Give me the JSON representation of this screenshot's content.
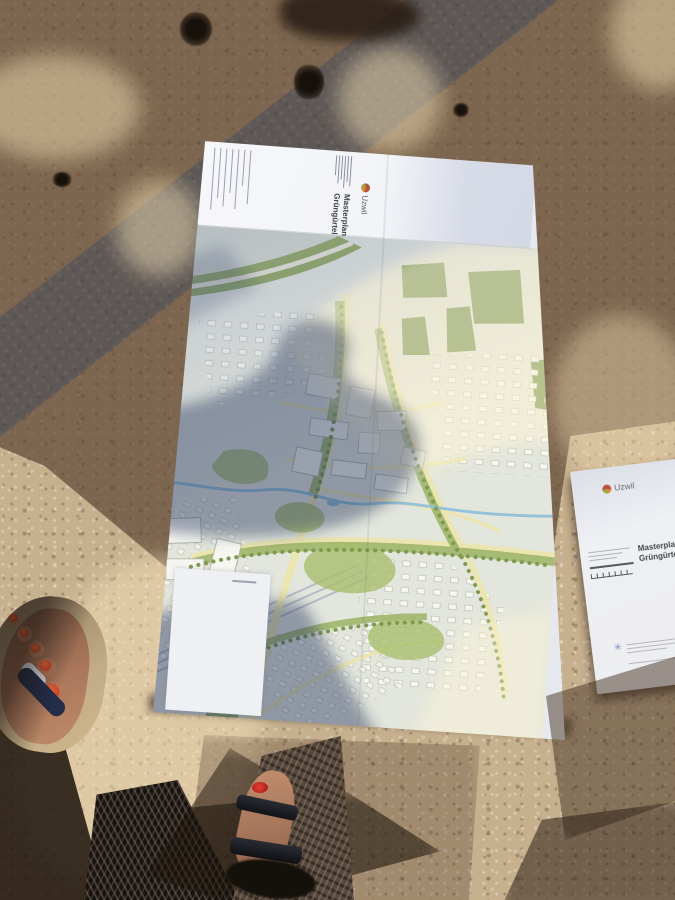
{
  "map_sheet": {
    "title_block": {
      "title_line1": "Masterplan",
      "title_line2": "Grüngürtel",
      "brand": "Uzwil"
    }
  },
  "right_paper": {
    "brand": "Uzwil",
    "title_line1": "Masterplan",
    "title_line2": "Grüngürtel Uzwil"
  },
  "colors": {
    "pavement_sunlit": "#c7b08e",
    "pavement_shadow": "#5a432f",
    "painted_line_blue": "#5a82a8",
    "paper_white": "#eef0f4",
    "map_green": "#7f9c4d",
    "map_road_yellow": "#ebe5b2",
    "toenail_polish": "#d8542e",
    "brand_logo_red": "#c2503e",
    "footer_logo_blue": "#7b97c9"
  }
}
